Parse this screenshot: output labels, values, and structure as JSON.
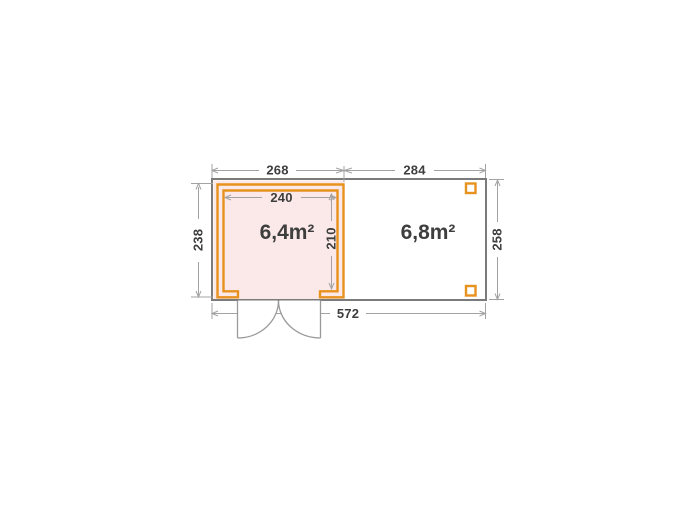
{
  "diagram": {
    "type": "garden-house-floor-plan",
    "areas": {
      "cabin_label": "6,4m²",
      "terrace_label": "6,8m²"
    },
    "dimensions": {
      "top_left_width": "268",
      "top_right_width": "284",
      "inner_width": "240",
      "inner_height": "210",
      "left_height": "238",
      "right_height": "258",
      "total_width": "572"
    },
    "colors": {
      "wall_orange": "#E8921E",
      "cabin_floor_pink": "#FBE9E9",
      "outline_gray": "#7B7B7B",
      "dimension_gray": "#A3A3A3",
      "door_gray": "#9A9A9A",
      "text_dark": "#3E3E3E"
    }
  }
}
